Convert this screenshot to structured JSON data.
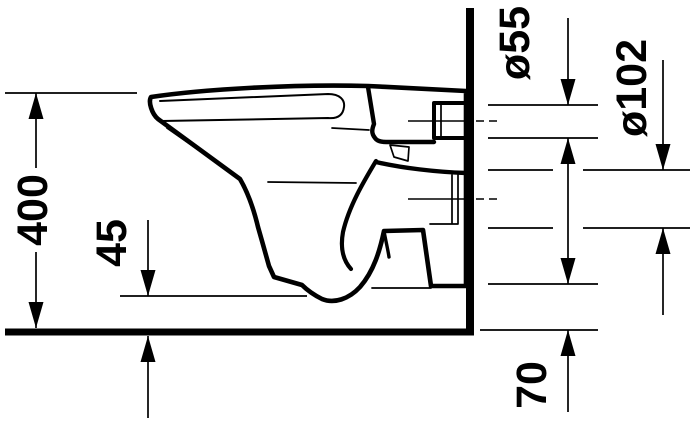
{
  "drawing": {
    "type": "technical-elevation-side-view",
    "subject": "wall-hung toilet",
    "colors": {
      "ink": "#000000",
      "background": "#ffffff"
    },
    "labels": {
      "overall_height": "400",
      "bowl_bottom_clearance": "45",
      "inlet_connector_diameter": "ø55",
      "outlet_connector_diameter": "ø102",
      "outlet_bottom_clearance": "70"
    }
  }
}
